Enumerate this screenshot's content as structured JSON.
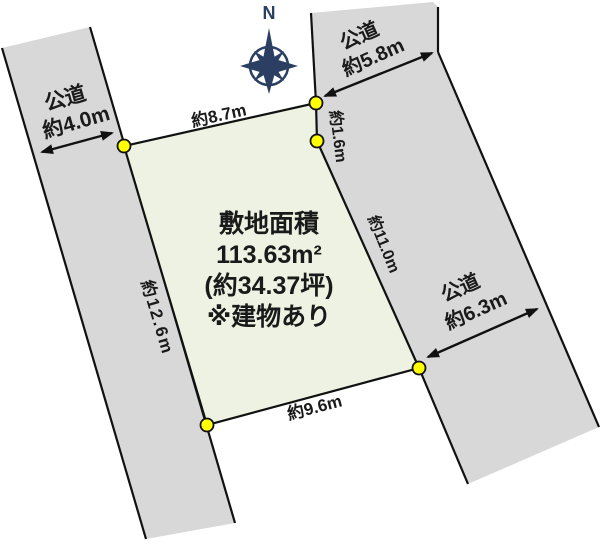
{
  "compass": {
    "label": "N"
  },
  "plot": {
    "title": "敷地面積",
    "area_m2": "113.63m²",
    "area_tsubo": "(約34.37坪)",
    "note": "※建物あり",
    "dim_top": "約8.7m",
    "dim_left": "約12.6m",
    "dim_right": "約11.0m",
    "dim_bottom": "約9.6m",
    "dim_corner": "約1.6m"
  },
  "roads": {
    "left": {
      "label": "公道",
      "width": "約4.0m"
    },
    "top": {
      "label": "公道",
      "width": "約5.8m"
    },
    "right": {
      "label": "公道",
      "width": "約6.3m"
    }
  },
  "colors": {
    "road_fill": "#d8d8d8",
    "plot_fill": "#edf2e2",
    "marker": "#ffff00",
    "compass": "#2b3f63",
    "line": "#111111",
    "text": "#1a1a1a"
  }
}
